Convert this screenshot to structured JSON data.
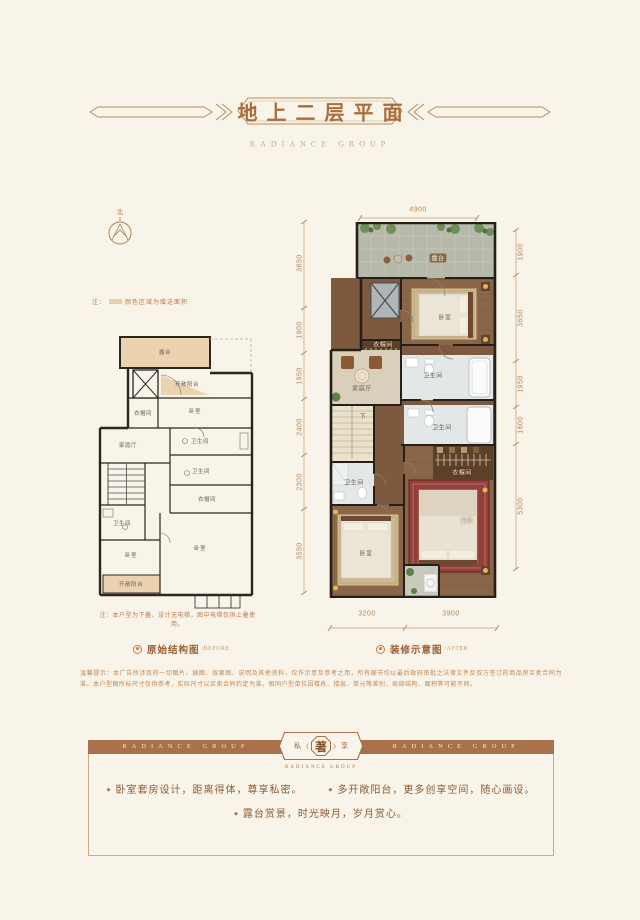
{
  "header": {
    "title": "地上二层平面",
    "brand": "RADIANCE GROUP"
  },
  "compass": {
    "north_label": "北"
  },
  "legend_note": {
    "prefix": "注：",
    "swatch_color": "#e9cfa9",
    "text": "颜色区域为赠送面积"
  },
  "plans": {
    "before": {
      "caption": "原始结构图",
      "caption_en": "/BEFORE",
      "note": "注：本户型为下叠，设计无电梯，图中电梯仅供上叠使用。",
      "rooms": [
        "露台",
        "开敞阳台",
        "卧室",
        "衣帽间",
        "家庭厅",
        "卫生间",
        "卫生间",
        "衣帽间",
        "卫生间",
        "卧室",
        "卧室",
        "开敞阳台"
      ]
    },
    "after": {
      "caption": "装修示意图",
      "caption_en": "/AFTER",
      "rooms": [
        "露台",
        "卧室",
        "衣帽间",
        "家庭厅",
        "卫生间",
        "下",
        "卫生间",
        "衣帽间",
        "卫生间",
        "卧室",
        "主卧"
      ],
      "dims": {
        "top": [
          "4900"
        ],
        "left": [
          "3650",
          "1900",
          "1950",
          "2400",
          "2300",
          "3550"
        ],
        "right": [
          "1900",
          "3650",
          "1950",
          "1600",
          "5300"
        ],
        "bottom": [
          "3200",
          "3900"
        ]
      }
    }
  },
  "banner": {
    "ribbon_left": "RADIANCE GROUP",
    "ribbon_right": "RADIANCE GROUP",
    "seal": {
      "left": "私",
      "deco_left": "《",
      "center": "著",
      "deco_right": "》",
      "right": "享",
      "sub": "RADIANCE GROUP"
    },
    "bullets": [
      "卧室套房设计，距离得体，尊享私密。",
      "多开敞阳台，更多创享空间，随心画设。",
      "露台赏景，时光映月，岁月赏心。"
    ]
  },
  "disclaimer": "温馨提示：本广告所涉及的一切图片、插图、效果图、说明及其他资料，仅作示意及参考之用，所有细节均以最后政府审批之法律文件及双方签订的商品房买卖合同为准。本户型图所标尺寸仅供参考，实际尺寸以买卖合同约定为准。相同户型单位因楼栋、楼层、单元等差别，局部结构、面积等可能不同。",
  "accent_colors": {
    "ribbon": "#a8714b",
    "title": "#ad6b3a",
    "gift_area": "#e9cfa9"
  }
}
